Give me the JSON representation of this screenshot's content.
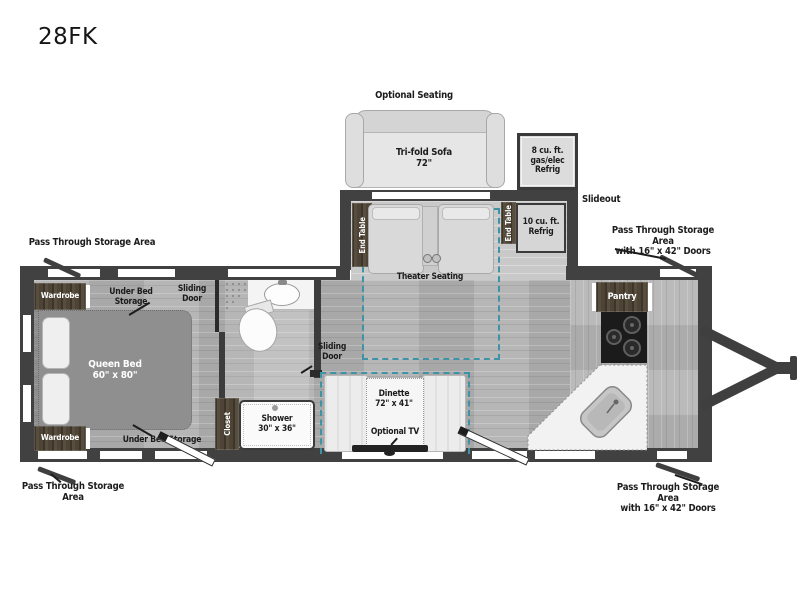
{
  "page": {
    "title": "28FK"
  },
  "colors": {
    "accent_teal": "#3f93a6",
    "wall": "#414141",
    "cabinet_brown": "#4e4435"
  },
  "labels": {
    "optional_seating": "Optional Seating",
    "trifold_sofa": "Tri-fold Sofa\n72\"",
    "refrig8": "8 cu. ft.\ngas/elec\nRefrig",
    "slideout": "Slideout",
    "end_table": "End Table",
    "refrig10": "10 cu. ft.\nRefrig",
    "theater_seating": "Theater Seating",
    "pass_through": "Pass Through Storage Area",
    "pass_through_doors": "Pass Through Storage Area\nwith 16\" x 42\" Doors",
    "pantry": "Pantry",
    "wardrobe": "Wardrobe",
    "under_bed_storage": "Under Bed Storage",
    "sliding_door": "Sliding\nDoor",
    "queen_bed": "Queen Bed\n60\" x 80\"",
    "dinette": "Dinette\n72\" x 41\"",
    "optional_tv": "Optional TV",
    "closet": "Closet",
    "shower": "Shower\n30\" x 36\""
  }
}
